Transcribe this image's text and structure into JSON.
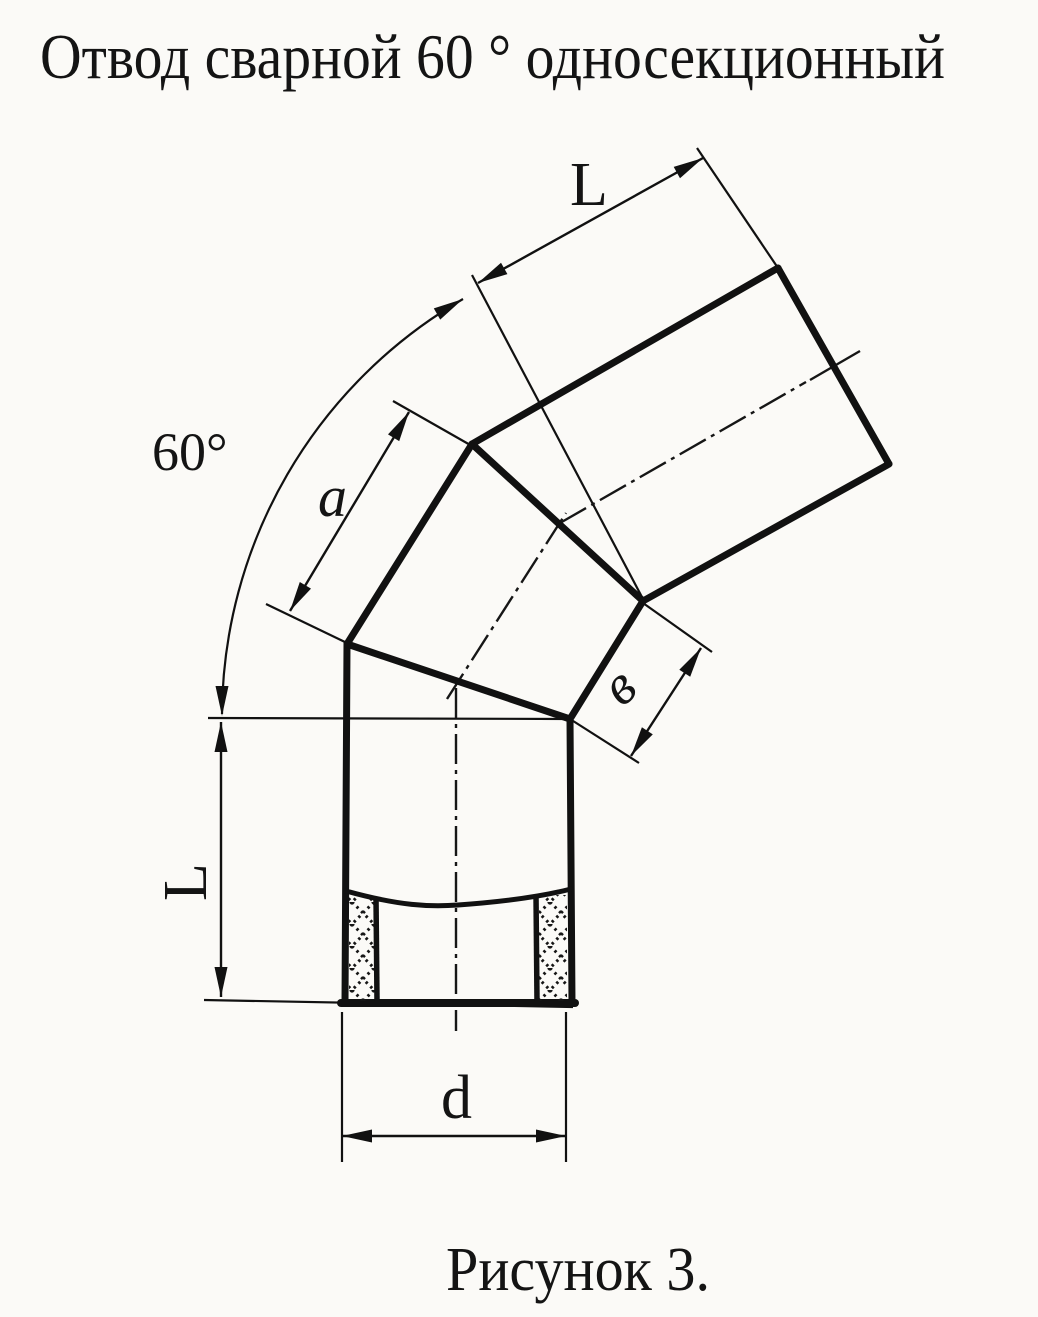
{
  "meta": {
    "background": "#fbfaf7",
    "ink": "#141414",
    "line_color": "#111111"
  },
  "title": {
    "text": "Отвод сварной 60 ° односекционный"
  },
  "figure": {
    "caption": "Рисунок 3.",
    "labels": {
      "angle": "60°",
      "top_length": "L",
      "gore_a": "a",
      "gore_b": "в",
      "left_length": "L",
      "diameter": "d"
    }
  }
}
